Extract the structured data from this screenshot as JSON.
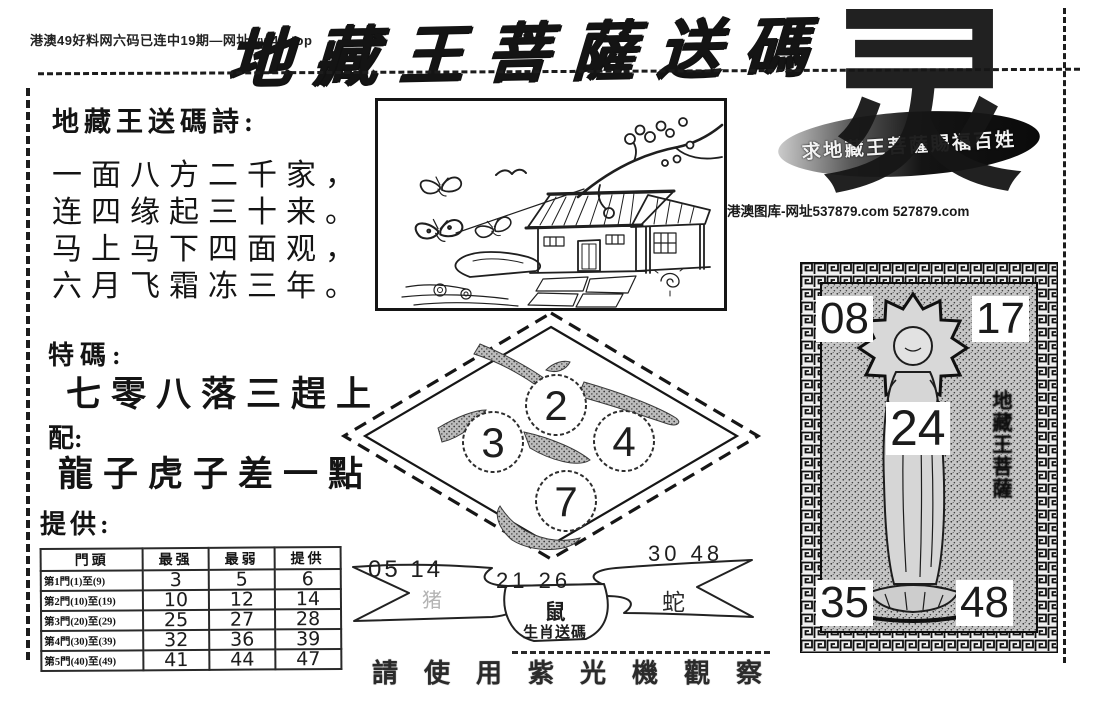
{
  "colors": {
    "ink": "#141414",
    "paper": "#ffffff",
    "faded_ink": "#b3b3b3"
  },
  "header": {
    "site_note": "港澳49好料网六码已连中19期—网址ww49.top",
    "title": "地藏王菩薩送碼"
  },
  "poem": {
    "heading": "地藏王送碼詩:",
    "lines": [
      "一面八方二千家，",
      "连四缘起三十来。",
      "马上马下四面观，",
      "六月飞霜冻三年。"
    ]
  },
  "tips": {
    "special_label": "特碼:",
    "special_phrase": "七零八落三趕上",
    "pair_label": "配:",
    "pair_phrase": "龍子虎子差一點",
    "provide_label": "提供:"
  },
  "door_table": {
    "headers": [
      "門頭",
      "最强",
      "最弱",
      "提供"
    ],
    "rows": [
      {
        "door": "第1門(1)至(9)",
        "strong": "3",
        "weak": "5",
        "provide": "6"
      },
      {
        "door": "第2門(10)至(19)",
        "strong": "10",
        "weak": "12",
        "provide": "14"
      },
      {
        "door": "第3門(20)至(29)",
        "strong": "25",
        "weak": "27",
        "provide": "28"
      },
      {
        "door": "第4門(30)至(39)",
        "strong": "32",
        "weak": "36",
        "provide": "39"
      },
      {
        "door": "第5門(40)至(49)",
        "strong": "41",
        "weak": "44",
        "provide": "47"
      }
    ]
  },
  "diamond": {
    "numbers": [
      "2",
      "3",
      "4",
      "7"
    ]
  },
  "seal": {
    "blessing": "求地藏王菩薩賜福百姓",
    "big_character": "灵"
  },
  "library_note": "港澳图库-网址537879.com 527879.com",
  "zodiac_banner": {
    "left_numbers": "05 14",
    "center_numbers": "21 26",
    "right_numbers": "30 48",
    "left_zodiac": "猪",
    "center_zodiac": "鼠",
    "right_zodiac": "蛇",
    "caption": "生肖送碼"
  },
  "deity_panel": {
    "numbers": {
      "top_left": "08",
      "top_right": "17",
      "center": "24",
      "bottom_left": "35",
      "bottom_right": "48"
    },
    "side_label": "地藏王菩薩"
  },
  "footer": {
    "uv_note": "請使用紫光機觀察"
  }
}
